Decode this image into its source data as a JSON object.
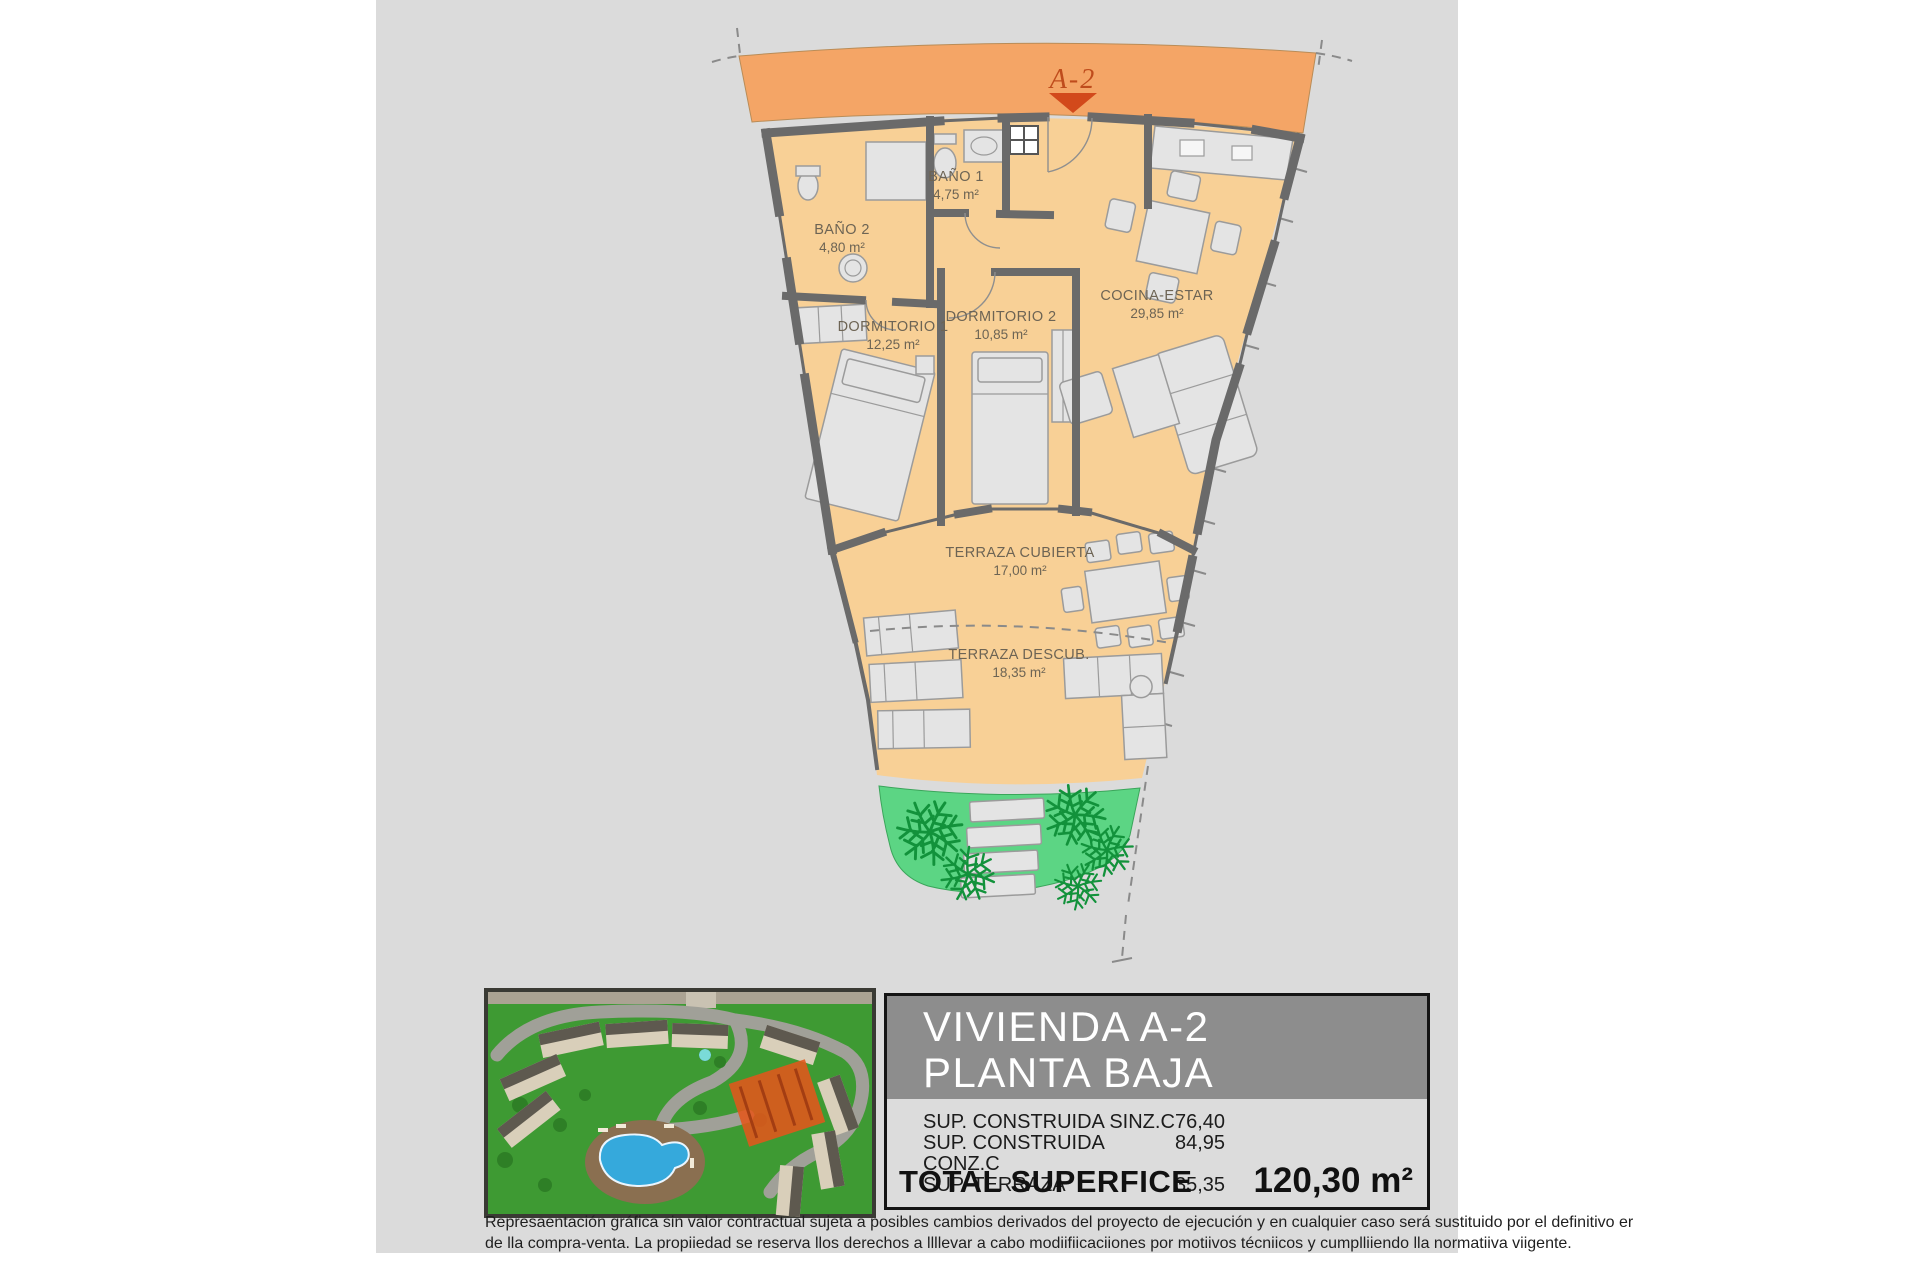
{
  "page": {
    "bg_color": "#ffffff",
    "panel_color": "#dbdbdb"
  },
  "plan": {
    "unit_label": "A-2",
    "band_color": "#f4a566",
    "floor_color": "#f8d096",
    "wall_color": "#6a6a6a",
    "garden_color": "#5cd584",
    "highlight_color": "#e2561b",
    "rooms": [
      {
        "name": "BAÑO 1",
        "area": "4,75 m²"
      },
      {
        "name": "BAÑO 2",
        "area": "4,80 m²"
      },
      {
        "name": "DORMITORIO 1",
        "area": "12,25 m²"
      },
      {
        "name": "DORMITORIO 2",
        "area": "10,85 m²"
      },
      {
        "name": "COCINA-ESTAR",
        "area": "29,85 m²"
      },
      {
        "name": "TERRAZA CUBIERTA",
        "area": "17,00 m²"
      },
      {
        "name": "TERRAZA DESCUB.",
        "area": "18,35 m²"
      }
    ]
  },
  "info_panel": {
    "title_line1": "VIVIENDA A-2",
    "title_line2": "PLANTA BAJA",
    "rows": [
      {
        "label": "SUP. CONSTRUIDA SINZ.C",
        "value": "76,40"
      },
      {
        "label": "SUP. CONSTRUIDA CONZ.C",
        "value": "84,95"
      },
      {
        "label": "SUP. TERRAZA",
        "value": "35,35"
      }
    ],
    "total_label": "TOTAL SUPERFICE",
    "total_value": "120,30 m²"
  },
  "disclaimer": {
    "line1": "Represaentación gráfica sin valor contractual sujeta a posibles cambios derivados del proyecto de ejecución y en cualquier caso será sustituido por el definitivo er",
    "line2": "de lla compra-venta. La propiiedad se reserva llos derechos a llllevar a cabo modiifiicaciiones por motiivos técniicos y cumplliiendo lla normatiiva viigente."
  }
}
